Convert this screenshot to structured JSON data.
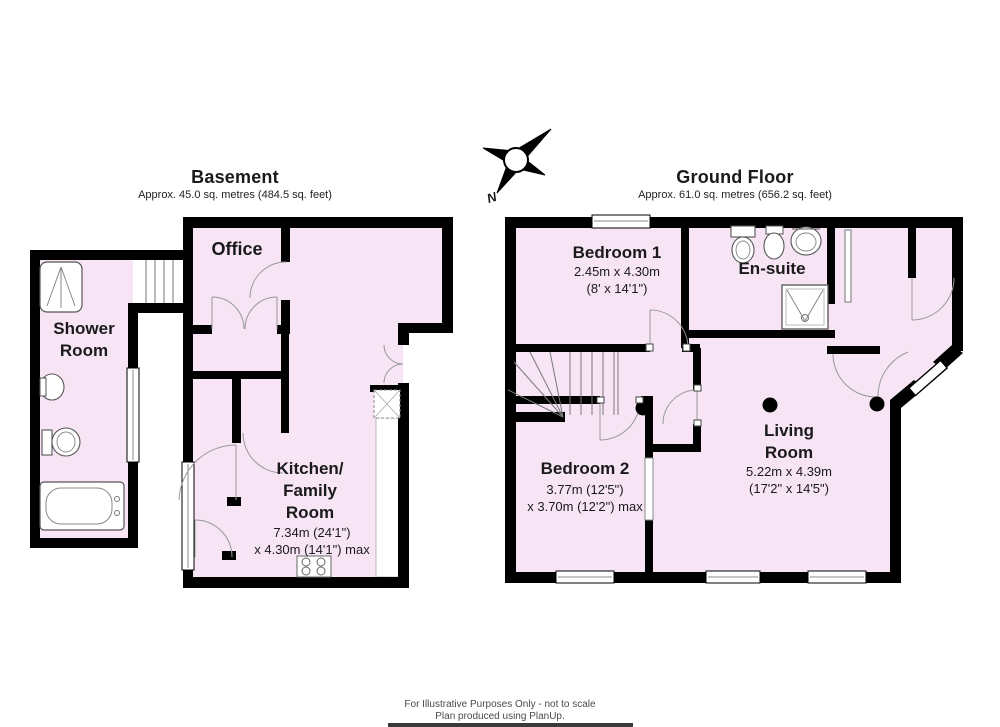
{
  "page": {
    "footer_line1": "For Illustrative Purposes Only - not to scale",
    "footer_line2": "Plan produced using PlanUp."
  },
  "compass": {
    "north_label": "N"
  },
  "colors": {
    "room_fill": "#f7e5f5",
    "wall": "#000000"
  },
  "basement": {
    "title": "Basement",
    "subtitle": "Approx. 45.0 sq. metres (484.5 sq. feet)",
    "rooms": {
      "office": {
        "name": "Office"
      },
      "shower_room": {
        "name": "Shower\nRoom"
      },
      "kitchen_family_room": {
        "name": "Kitchen/\nFamily\nRoom",
        "dims": "7.34m (24'1\")\nx 4.30m (14'1\") max"
      }
    }
  },
  "ground_floor": {
    "title": "Ground Floor",
    "subtitle": "Approx. 61.0 sq. metres (656.2 sq. feet)",
    "rooms": {
      "bedroom1": {
        "name": "Bedroom 1",
        "dims": "2.45m x 4.30m\n(8' x 14'1\")"
      },
      "ensuite": {
        "name": "En-suite"
      },
      "bedroom2": {
        "name": "Bedroom 2",
        "dims": "3.77m (12'5\")\nx 3.70m (12'2\") max"
      },
      "living_room": {
        "name": "Living\nRoom",
        "dims": "5.22m x 4.39m\n(17'2\" x 14'5\")"
      }
    }
  }
}
